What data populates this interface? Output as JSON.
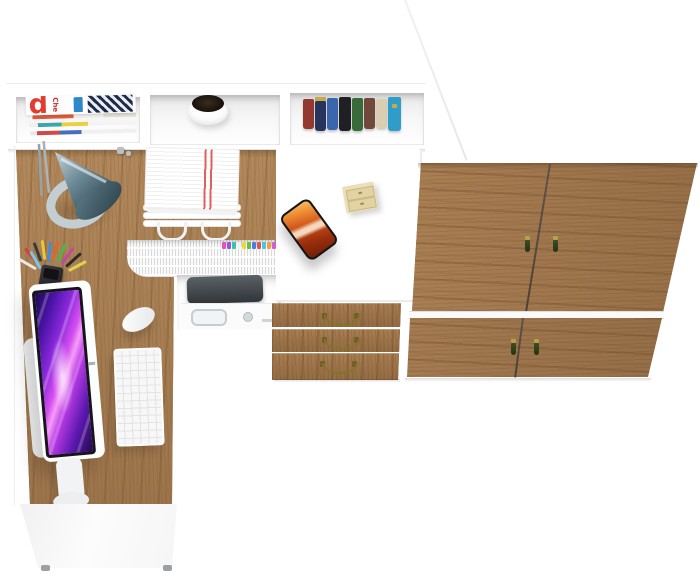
{
  "scene": {
    "subject": "White and oak corner computer desk set with hutch shelf, three-drawer unit and two-door wardrobe",
    "view": "top-down 3D product render",
    "background_color": "#ffffff"
  },
  "palette": {
    "desk_wood": "#a67c52",
    "wardrobe_wood": "#9c7349",
    "furniture_white": "#ffffff",
    "lamp_shade_steel_blue": "#50707c",
    "lamp_base_gray": "#c3ced2",
    "monitor_screen_magenta": "#d44ff0",
    "monitor_screen_violet": "#4a14a8",
    "phone_screen_orange": "#ef8f35",
    "drawer_handle_brass": "#857428",
    "wardrobe_handle_green": "#31411b",
    "paper_stripe_red": "#e06060"
  },
  "hutch": {
    "compartments": 3,
    "magazine_cover": {
      "big_letter": "d",
      "side_text": "Che"
    },
    "book_colors": [
      "#93392f",
      "#27345c",
      "#3a66ae",
      "#1f1f24",
      "#396b38",
      "#70493a",
      "#d9cdb2",
      "#2f9dc8"
    ]
  },
  "desk_items": [
    "desk lamp",
    "paper tray with documents",
    "plant pot",
    "magazine stack",
    "pencil cup",
    "all-in-one monitor",
    "keyboard",
    "mouse",
    "newspaper stack with index tabs",
    "printer on pull-out shelf",
    "smartphone",
    "mini desk organizer"
  ],
  "storage": {
    "drawer_count": 3,
    "wardrobe_door_count": 4,
    "wardrobe_handle_count": 4
  }
}
